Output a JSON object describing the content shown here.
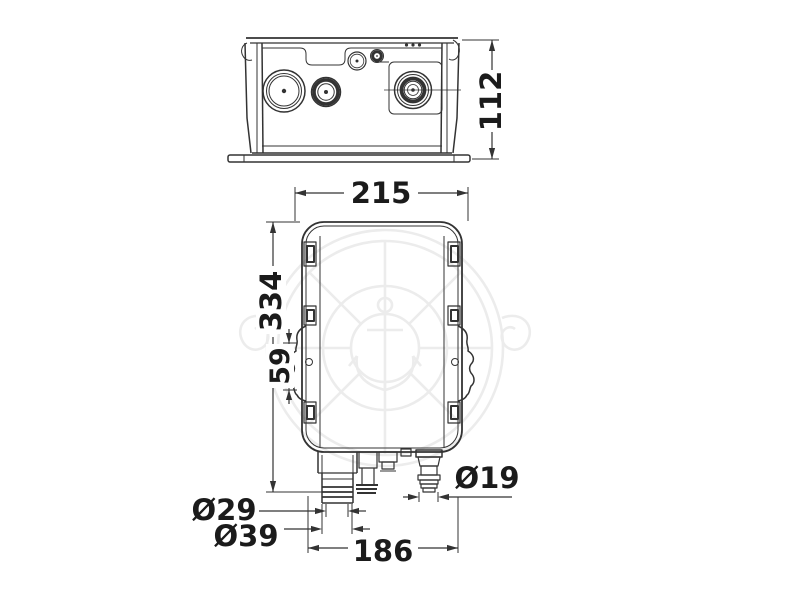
{
  "drawing": {
    "colors": {
      "line": "#333333",
      "text": "#1b1b1b",
      "watermark": "#ececec",
      "background": "#ffffff"
    },
    "dimensions": {
      "side_view_height": "112",
      "front_view_width": "215",
      "front_view_height": "334",
      "bracket_pitch": "59",
      "outlet_inner_diameter": "Ø29",
      "outlet_outer_diameter": "Ø39",
      "port_spacing": "186",
      "hose_barb_diameter": "Ø19"
    }
  }
}
